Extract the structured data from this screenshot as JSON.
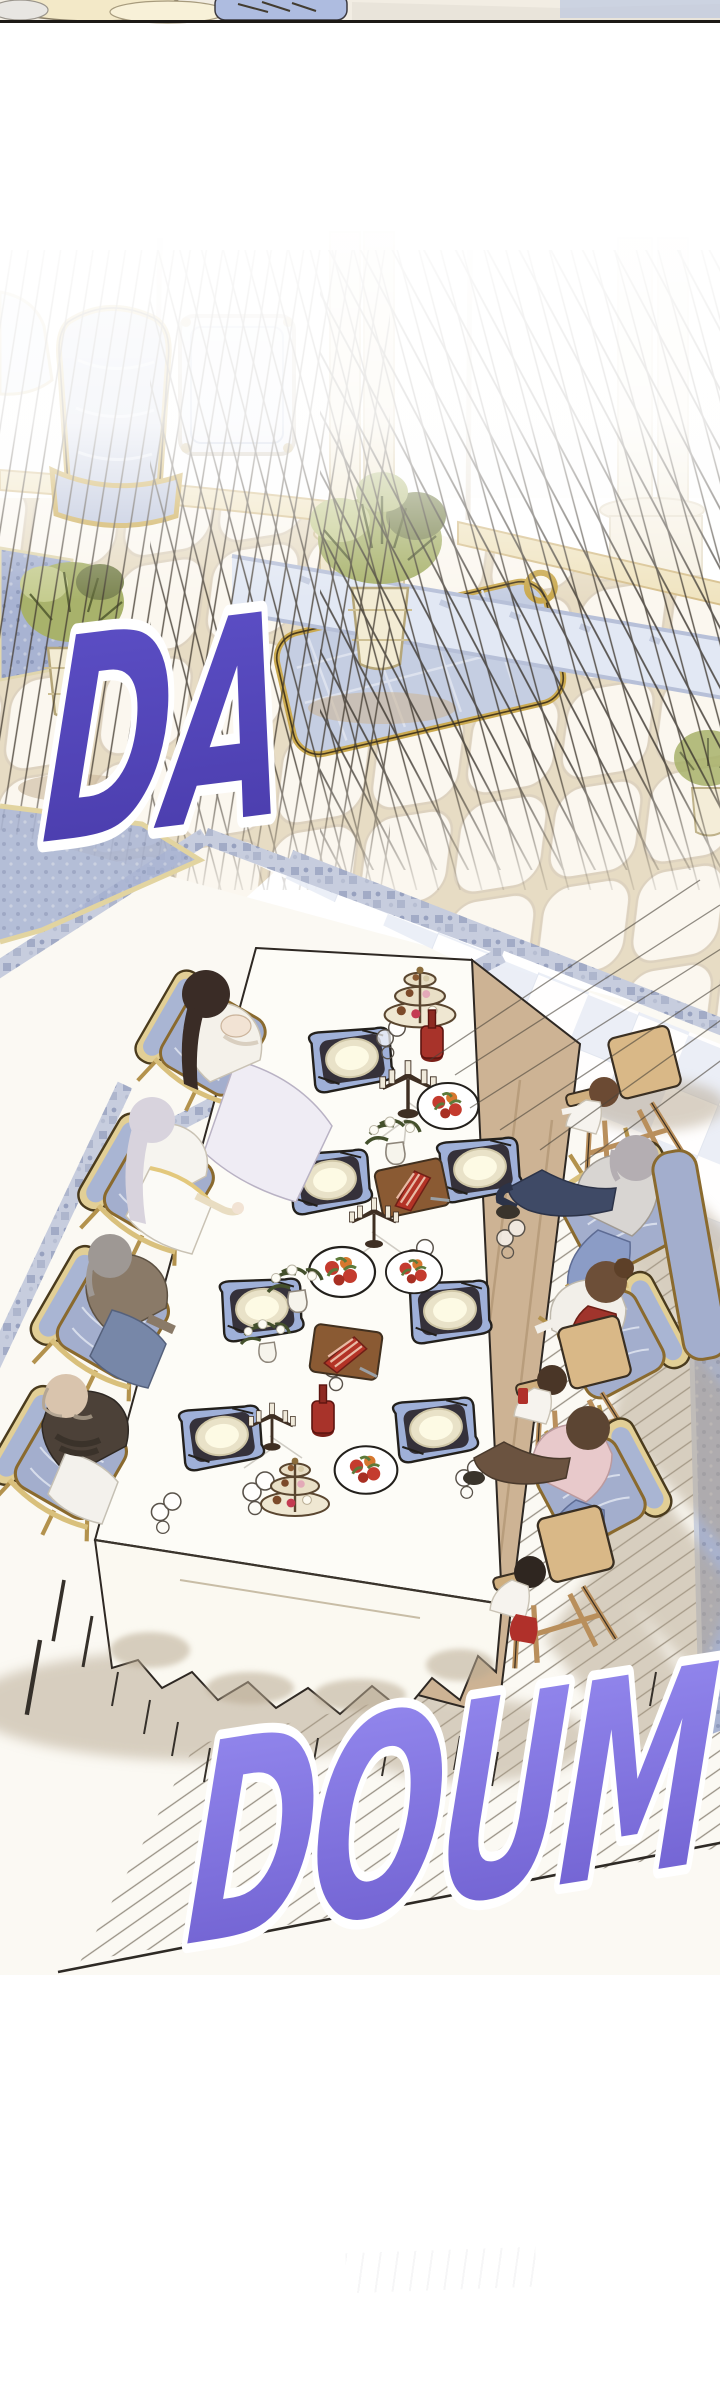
{
  "scene": {
    "panel_type": "webtoon-comic-panel",
    "sfx_da": {
      "text": "DA",
      "fill_top": "#5e51c8",
      "fill_bottom": "#483aa9",
      "outline": "#ffffff"
    },
    "sfx_doum": {
      "text": "DOUM",
      "fill_top": "#978cf1",
      "fill_bottom": "#6c5ccd",
      "outline": "#ffffff"
    },
    "setting": {
      "location": "palace dining hall",
      "diners_left": [
        "dark-haired woman holding baby",
        "long silver-haired woman in white-gold dress",
        "gray-haired man in brown sweater",
        "bald elder with crossed arms"
      ],
      "diners_right": [
        "baby in high chair",
        "silver-haired person in gray cardigan",
        "woman with bun in red vest",
        "child in high chair",
        "person in pink cardigan",
        "toddler in high chair"
      ]
    },
    "palette": {
      "paper": "#ffffff",
      "warm_floor": "#fbf8f1",
      "tile_grout": "#e7dcc4",
      "tile_face": "#fbf7ef",
      "gold_frame": "#e7d39c",
      "gold_line": "#b3924d",
      "upholstery_blue": "#a9b5d3",
      "check_blue": "#e9edf6",
      "band_blue": "#b9c1d8",
      "carpet_blue": "#a8b3d2",
      "table_side_tan": "#cdb394",
      "tablecloth": "#fdfcf7",
      "shadow_taupe": "#b4a48c",
      "speedline": "#3c352c",
      "outline_dark": "#2e2823"
    }
  }
}
